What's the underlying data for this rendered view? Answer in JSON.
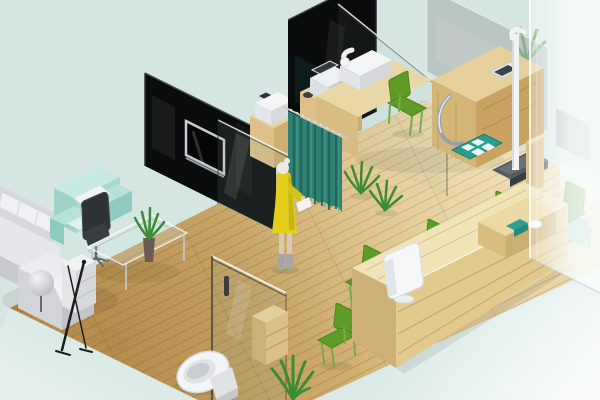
{
  "meta": {
    "type": "3d-isometric-interior-render",
    "description": "Isometric 3D rendering of a small clinic/office interior: waiting lounge with sofa, reception counter with green chairs, exam room with medical desk and height scale, privacy curtain with a standing woman, restroom with toilet behind a glass door, black partition walls and a frosted glass exterior wall.",
    "width": 600,
    "height": 400
  },
  "palette": {
    "background": "#d5e6e2",
    "wall_panel": "#0a0b0d",
    "curtain": "#2e8173",
    "curtain_stripe": "#1f6355",
    "chair_green": "#5f9c27",
    "chair_green_line": "#4c8420",
    "counter_wood": "#f0e3b8",
    "counter_front": "#e2c98e",
    "desk_wood": "#ead7a6",
    "sofa_gray": "#e6e7ea",
    "sofa_back": "#d6d7db",
    "armchair_mint": "#a8d9cf",
    "mat_teal": "#2a9d8f",
    "dress_yellow": "#e3cf1b",
    "plant_green": "#3e8b36",
    "device_white": "#f6f7f8",
    "toilet_white": "#f4f5f6",
    "floor_light": "#e8d6a6",
    "floor_dark": "#c79e5e"
  },
  "objects": {
    "floor": "wooden plank floor",
    "wall_a": "black partition wall with TV",
    "wall_b": "black partition wall",
    "tv": "wall mounted television",
    "glass_panels": "glass partition panes",
    "curtain": "teal privacy curtain",
    "woman": "woman in yellow dress",
    "exam_desk": "wooden exam desk with devices",
    "height_scale": "height and weight scale",
    "floor_mat": "teal floor mat",
    "frosted_wall": "frosted glass exterior wall",
    "reception_counter": "long wooden reception counter",
    "reception_monitor": "white monitor on counter",
    "office_chair": "white office chair",
    "green_chairs": "green visitor chairs",
    "sofa": "gray sectional sofa",
    "armchair": "mint armchair with pillow",
    "black_chair": "dark office chair",
    "coffee_table": "glass coffee table",
    "toilet": "toilet behind glass door",
    "plants": "potted ferns"
  }
}
